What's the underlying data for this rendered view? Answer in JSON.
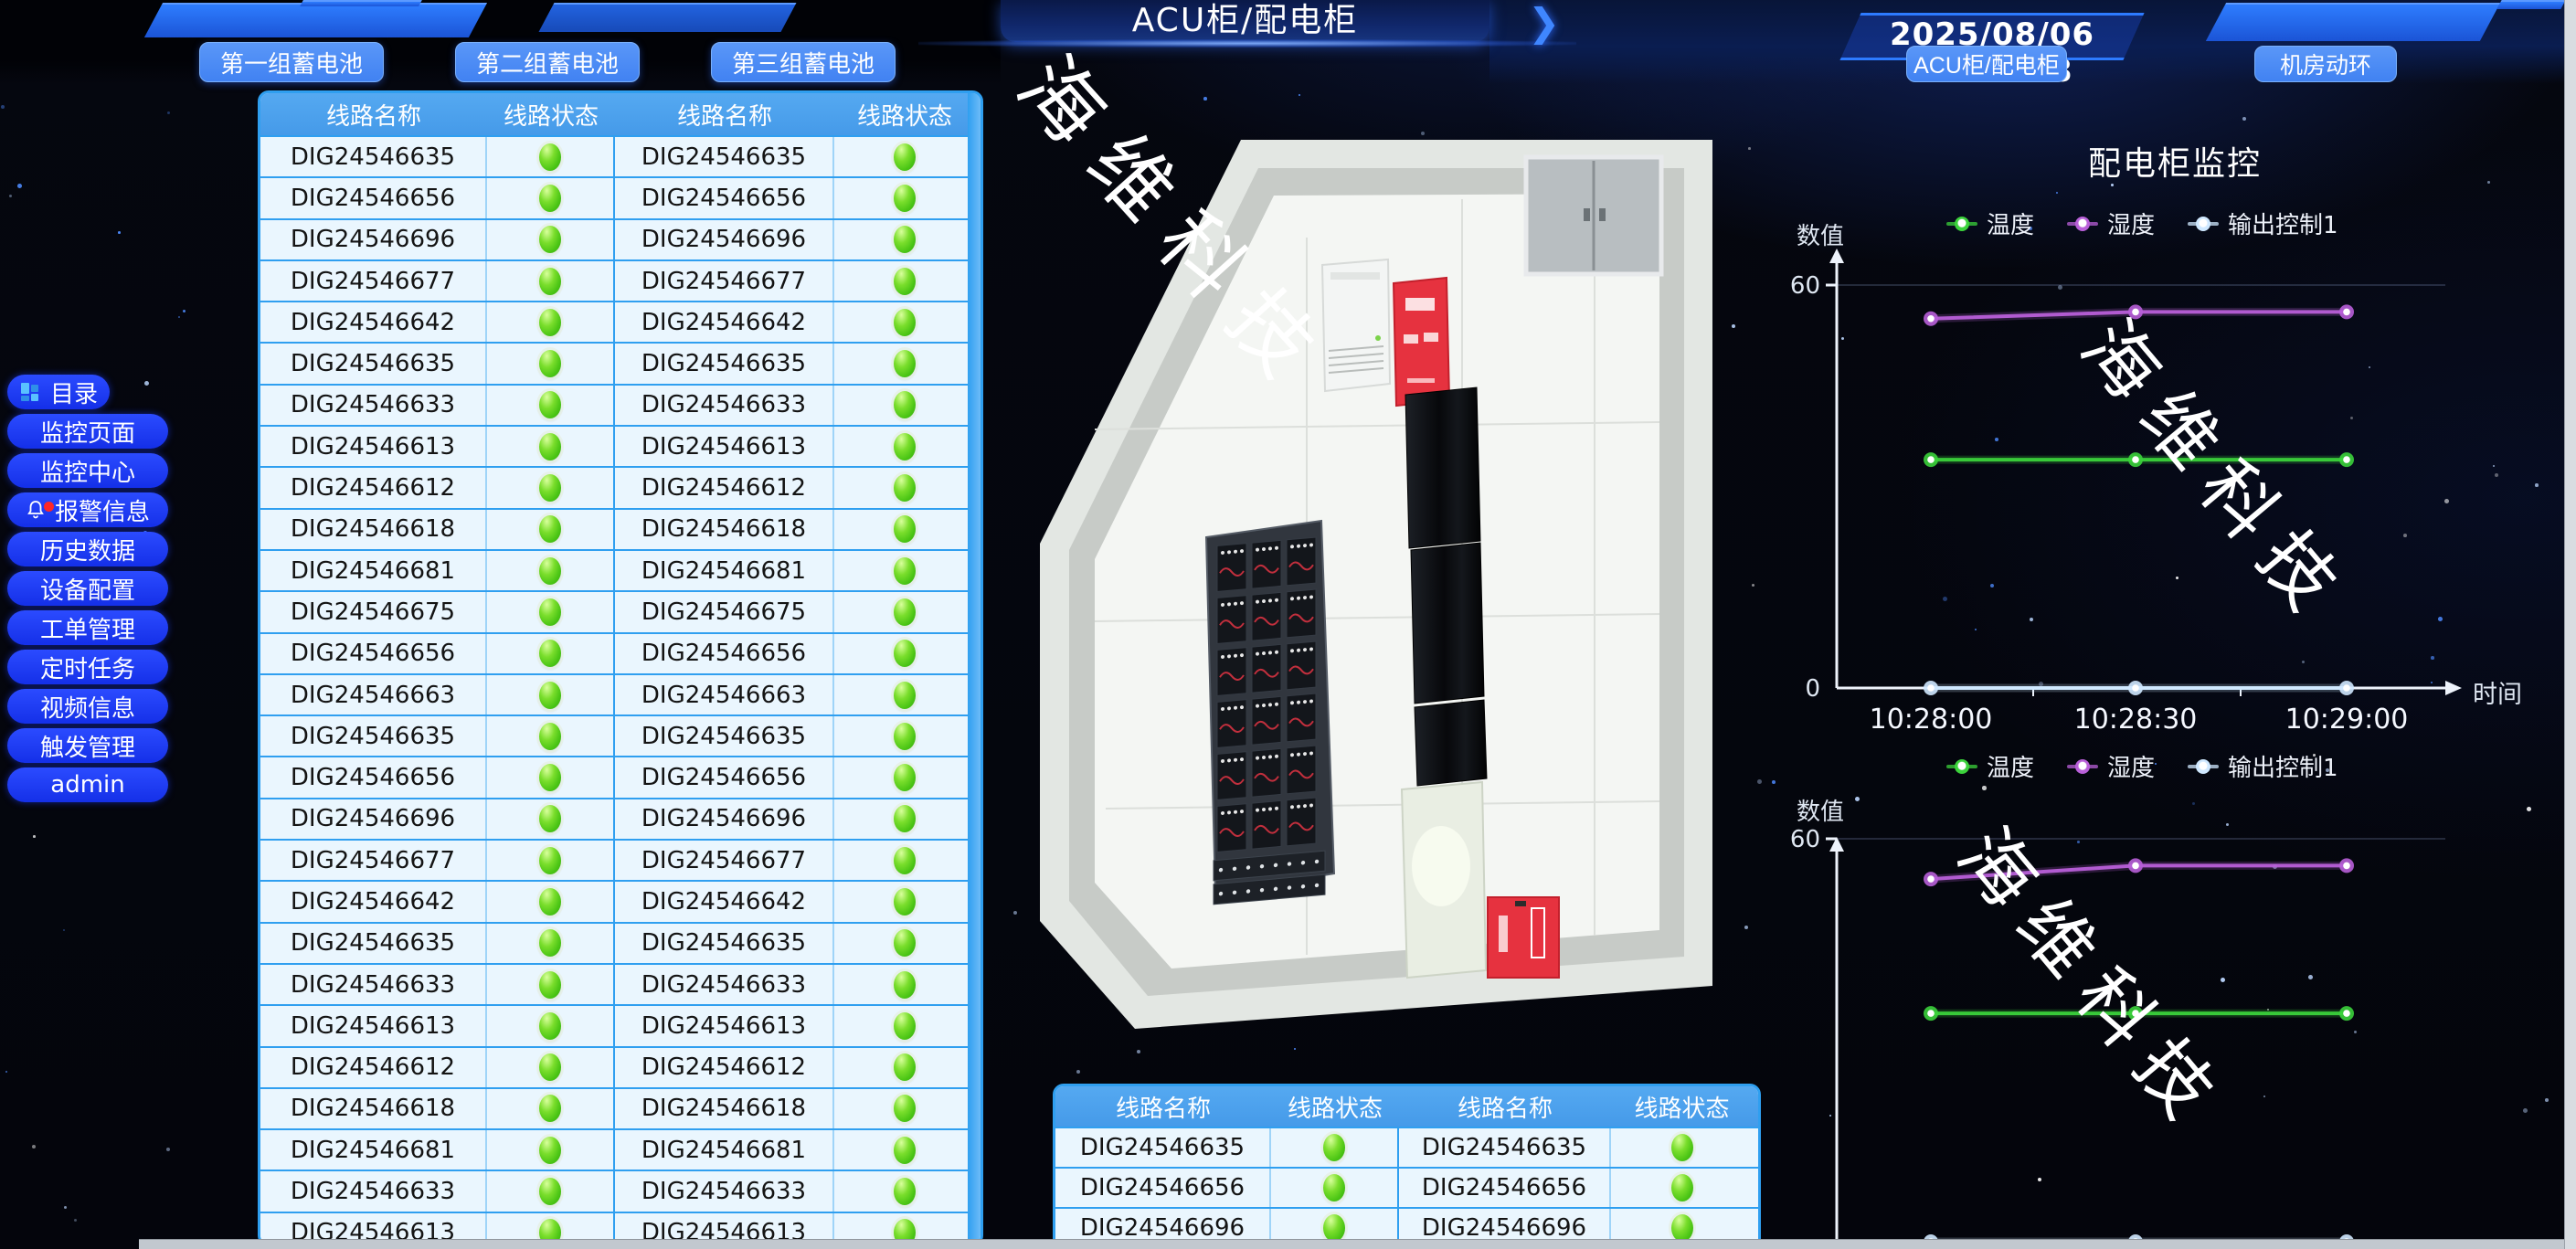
{
  "app": {
    "banner_title": "ACU柜/配电柜",
    "timestamp": "2025/08/06 09:51:18",
    "chevron": "❯"
  },
  "nav": {
    "battery_buttons": [
      "第一组蓄电池",
      "第二组蓄电池",
      "第三组蓄电池"
    ],
    "right_buttons": [
      "ACU柜/配电柜",
      "机房动环"
    ]
  },
  "sidebar": {
    "items": [
      {
        "label": "目录",
        "icon": "menu-grid-icon"
      },
      {
        "label": "监控页面"
      },
      {
        "label": "监控中心"
      },
      {
        "label": "报警信息",
        "icon": "bell-icon",
        "alert": true
      },
      {
        "label": "历史数据"
      },
      {
        "label": "设备配置"
      },
      {
        "label": "工单管理"
      },
      {
        "label": "定时任务"
      },
      {
        "label": "视频信息"
      },
      {
        "label": "触发管理"
      },
      {
        "label": "admin"
      }
    ]
  },
  "tables": {
    "headers": [
      "线路名称",
      "线路状态",
      "线路名称",
      "线路状态"
    ],
    "status_ok_color": "#54ce18",
    "main_rows": [
      "DIG24546635",
      "DIG24546656",
      "DIG24546696",
      "DIG24546677",
      "DIG24546642",
      "DIG24546635",
      "DIG24546633",
      "DIG24546613",
      "DIG24546612",
      "DIG24546618",
      "DIG24546681",
      "DIG24546675",
      "DIG24546656",
      "DIG24546663",
      "DIG24546635",
      "DIG24546656",
      "DIG24546696",
      "DIG24546677",
      "DIG24546642",
      "DIG24546635",
      "DIG24546633",
      "DIG24546613",
      "DIG24546612",
      "DIG24546618",
      "DIG24546681",
      "DIG24546633",
      "DIG24546613",
      "DIG24546612"
    ],
    "bottom_rows": [
      "DIG24546635",
      "DIG24546656",
      "DIG24546696",
      "DIG24546677"
    ]
  },
  "watermark": "海维科技",
  "chart_data": [
    {
      "type": "line",
      "title": "配电柜监控",
      "x": [
        "10:28:00",
        "10:28:30",
        "10:29:00"
      ],
      "xlabel": "时间",
      "ylabel": "数值",
      "ylim": [
        0,
        60
      ],
      "legend_position": "top",
      "grid": false,
      "series": [
        {
          "name": "温度",
          "color": "#3bd23b",
          "values": [
            34,
            34,
            34
          ]
        },
        {
          "name": "湿度",
          "color": "#b85fd8",
          "values": [
            55,
            56,
            56
          ]
        },
        {
          "name": "输出控制1",
          "color": "#cfe8ff",
          "values": [
            0,
            0,
            0
          ]
        }
      ]
    },
    {
      "type": "line",
      "title": "",
      "x": [
        "10:28:00",
        "10:28:30",
        "10:29:00"
      ],
      "xlabel": "",
      "ylabel": "数值",
      "ylim": [
        0,
        60
      ],
      "legend_position": "top",
      "grid": false,
      "series": [
        {
          "name": "温度",
          "color": "#3bd23b",
          "values": [
            34,
            34,
            34
          ]
        },
        {
          "name": "湿度",
          "color": "#b85fd8",
          "values": [
            54,
            56,
            56
          ]
        },
        {
          "name": "输出控制1",
          "color": "#cfe8ff",
          "values": [
            0,
            0,
            0
          ]
        }
      ]
    }
  ]
}
